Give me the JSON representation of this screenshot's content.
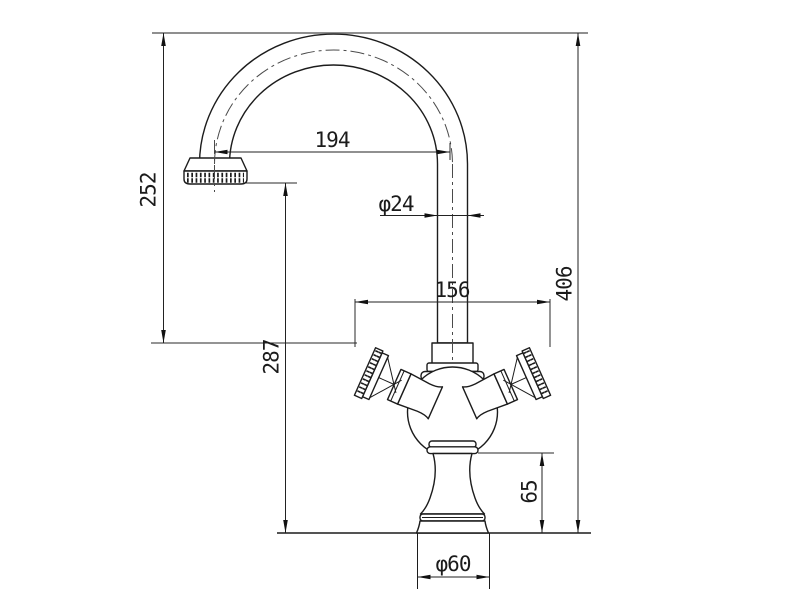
{
  "drawing": {
    "subject": "Gooseneck two-cross-handle faucet, front elevation with dimensions",
    "labels": {
      "spout_reach": "194",
      "spout_height": "252",
      "spout_tube_diameter": "φ24",
      "handle_span": "156",
      "overall_height": "406",
      "outlet_height": "287",
      "base_column_height": "65",
      "base_diameter": "φ60"
    },
    "colors": {
      "ink": "#1c1c1c",
      "dimension": "#222222",
      "centerline": "#4a4a4a",
      "reference_line": "#8f8f8f",
      "background": "#ffffff"
    }
  }
}
